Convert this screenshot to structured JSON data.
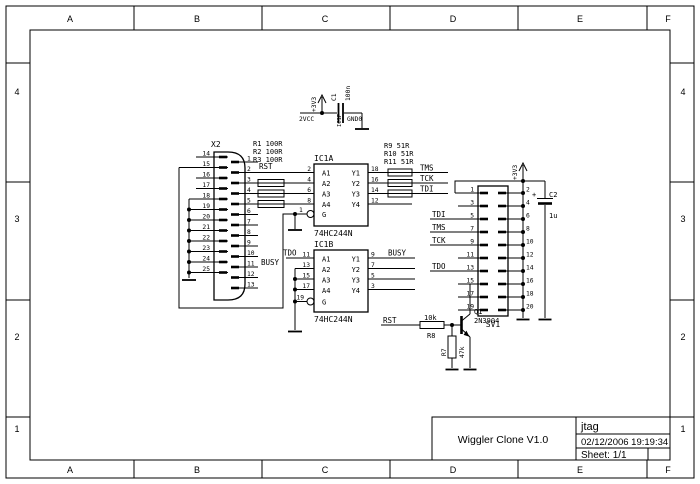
{
  "frame": {
    "cols": [
      "A",
      "B",
      "C",
      "D",
      "E",
      "F"
    ],
    "rows": [
      "4",
      "3",
      "2",
      "1"
    ]
  },
  "title_block": {
    "title": "Wiggler Clone V1.0",
    "project": "jtag",
    "datetime": "02/12/2006 19:19:34",
    "sheet": "Sheet: 1/1"
  },
  "power": {
    "v33": "+3V3",
    "vcc_pin": "2VCC",
    "gnd_pin": "GND0",
    "ic1p": "IC1P"
  },
  "c1": {
    "ref": "C1",
    "value": "100n"
  },
  "c2": {
    "ref": "C2",
    "value": "1u",
    "plus": "+"
  },
  "x2": {
    "ref": "X2",
    "left": [
      "14",
      "15",
      "16",
      "17",
      "18",
      "19",
      "20",
      "21",
      "22",
      "23",
      "24",
      "25"
    ],
    "right": [
      "1",
      "2",
      "3",
      "4",
      "5",
      "6",
      "7",
      "8",
      "9",
      "10",
      "11",
      "12",
      "13"
    ]
  },
  "sv1": {
    "ref": "SV1",
    "left": [
      "1",
      "3",
      "5",
      "7",
      "9",
      "11",
      "13",
      "15",
      "17",
      "19"
    ],
    "right": [
      "2",
      "4",
      "6",
      "8",
      "10",
      "12",
      "14",
      "16",
      "18",
      "20"
    ]
  },
  "ic1a": {
    "ref": "IC1A",
    "part": "74HC244N",
    "in_labels": [
      "A1",
      "A2",
      "A3",
      "A4"
    ],
    "out_labels": [
      "Y1",
      "Y2",
      "Y3",
      "Y4"
    ],
    "in_pins": [
      "2",
      "4",
      "6",
      "8"
    ],
    "out_pins": [
      "18",
      "16",
      "14",
      "12"
    ],
    "gate": "G",
    "gate_pin": "1"
  },
  "ic1b": {
    "ref": "IC1B",
    "part": "74HC244N",
    "in_labels": [
      "A1",
      "A2",
      "A3",
      "A4"
    ],
    "out_labels": [
      "Y1",
      "Y2",
      "Y3",
      "Y4"
    ],
    "in_pins": [
      "11",
      "13",
      "15",
      "17"
    ],
    "out_pins": [
      "9",
      "7",
      "5",
      "3"
    ],
    "gate": "G",
    "gate_pin": "19"
  },
  "resistors_left": [
    "R1 100R",
    "R2 100R",
    "R3 100R"
  ],
  "resistors_right": [
    "R9  51R",
    "R10 51R",
    "R11 51R"
  ],
  "r8": {
    "ref": "R8",
    "value": "10k"
  },
  "r7": {
    "ref": "R7",
    "value": "47k"
  },
  "q1": {
    "ref": "Q1",
    "part": "2N3904"
  },
  "nets": {
    "rst": "RST",
    "busy": "BUSY",
    "tms": "TMS",
    "tck": "TCK",
    "tdi": "TDI",
    "tdo": "TDO"
  }
}
